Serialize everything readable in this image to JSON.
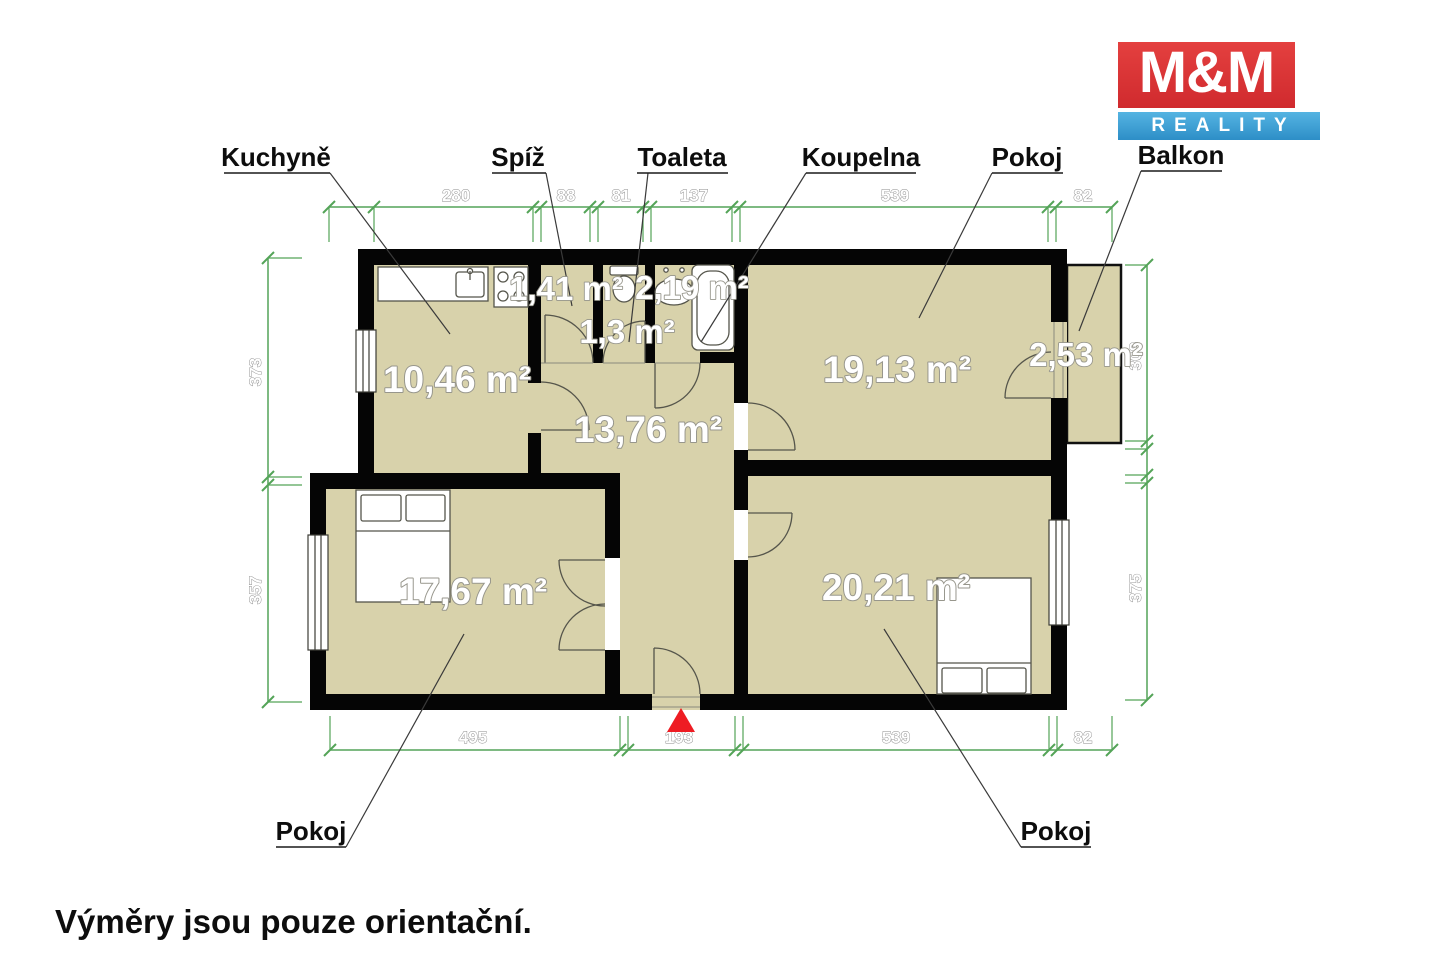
{
  "logo": {
    "top": "M&M",
    "bottom": "REALITY"
  },
  "labels": {
    "kitchen": "Kuchyně",
    "pantry": "Spíž",
    "toilet": "Toaleta",
    "bathroom": "Koupelna",
    "room_top": "Pokoj",
    "balcony": "Balkon",
    "room_bottom_left": "Pokoj",
    "room_bottom_right": "Pokoj"
  },
  "areas": {
    "kitchen": "10,46 m²",
    "pantry": "1,41 m²",
    "toilet": "1,3 m²",
    "bathroom": "2,19 m²",
    "hall": "13,76 m²",
    "room_right_top": "19,13 m²",
    "balcony": "2,53 m²",
    "room_left": "17,67 m²",
    "room_right_bottom": "20,21 m²"
  },
  "dimensions": {
    "top": [
      "280",
      "88",
      "81",
      "137",
      "539",
      "82"
    ],
    "bottom": [
      "495",
      "193",
      "539",
      "82"
    ],
    "left": [
      "373",
      "357"
    ],
    "right": [
      "309",
      "375"
    ]
  },
  "disclaimer": "Výměry jsou pouze orientační.",
  "colors": {
    "floor": "#d8d2ab",
    "wall": "#050505",
    "dimension": "#54a458",
    "entrance_marker": "#ee1c23",
    "logo_red": "#dc3236",
    "logo_blue": "#42a7dc"
  }
}
